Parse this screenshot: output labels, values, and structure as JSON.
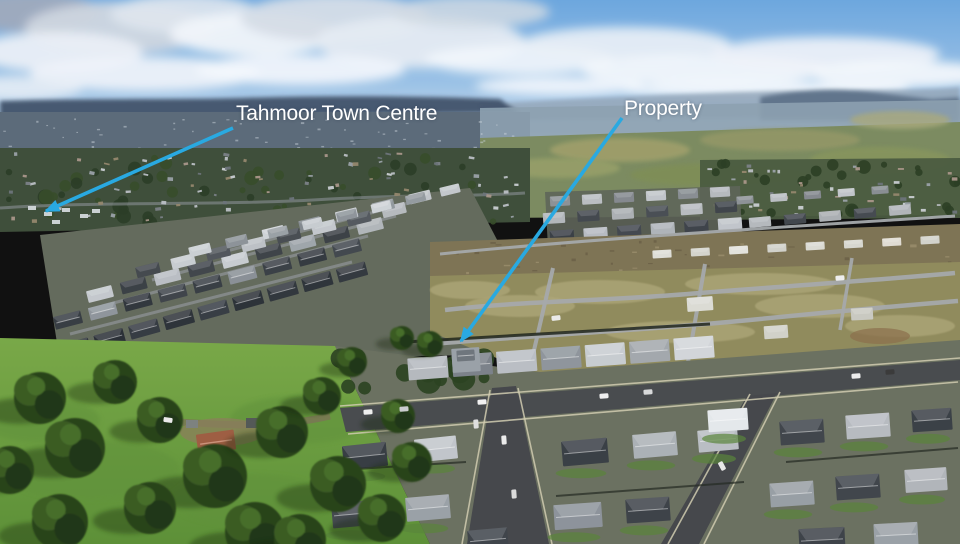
{
  "meta": {
    "description": "Aerial drone photograph over a new housing estate at Tahmoor with two annotation arrows",
    "scene": "aerial-photo"
  },
  "annotations": {
    "arrow_color": "#29a9e1",
    "label_color": "#ffffff",
    "items": [
      {
        "id": "town-centre",
        "label": "Tahmoor Town Centre",
        "label_pos": {
          "x": 236,
          "y": 102
        },
        "arrow": {
          "x1": 233,
          "y1": 128,
          "x2": 46,
          "y2": 211
        }
      },
      {
        "id": "property",
        "label": "Property",
        "label_pos": {
          "x": 624,
          "y": 97
        },
        "arrow": {
          "x1": 622,
          "y1": 118,
          "x2": 461,
          "y2": 341
        }
      }
    ]
  }
}
